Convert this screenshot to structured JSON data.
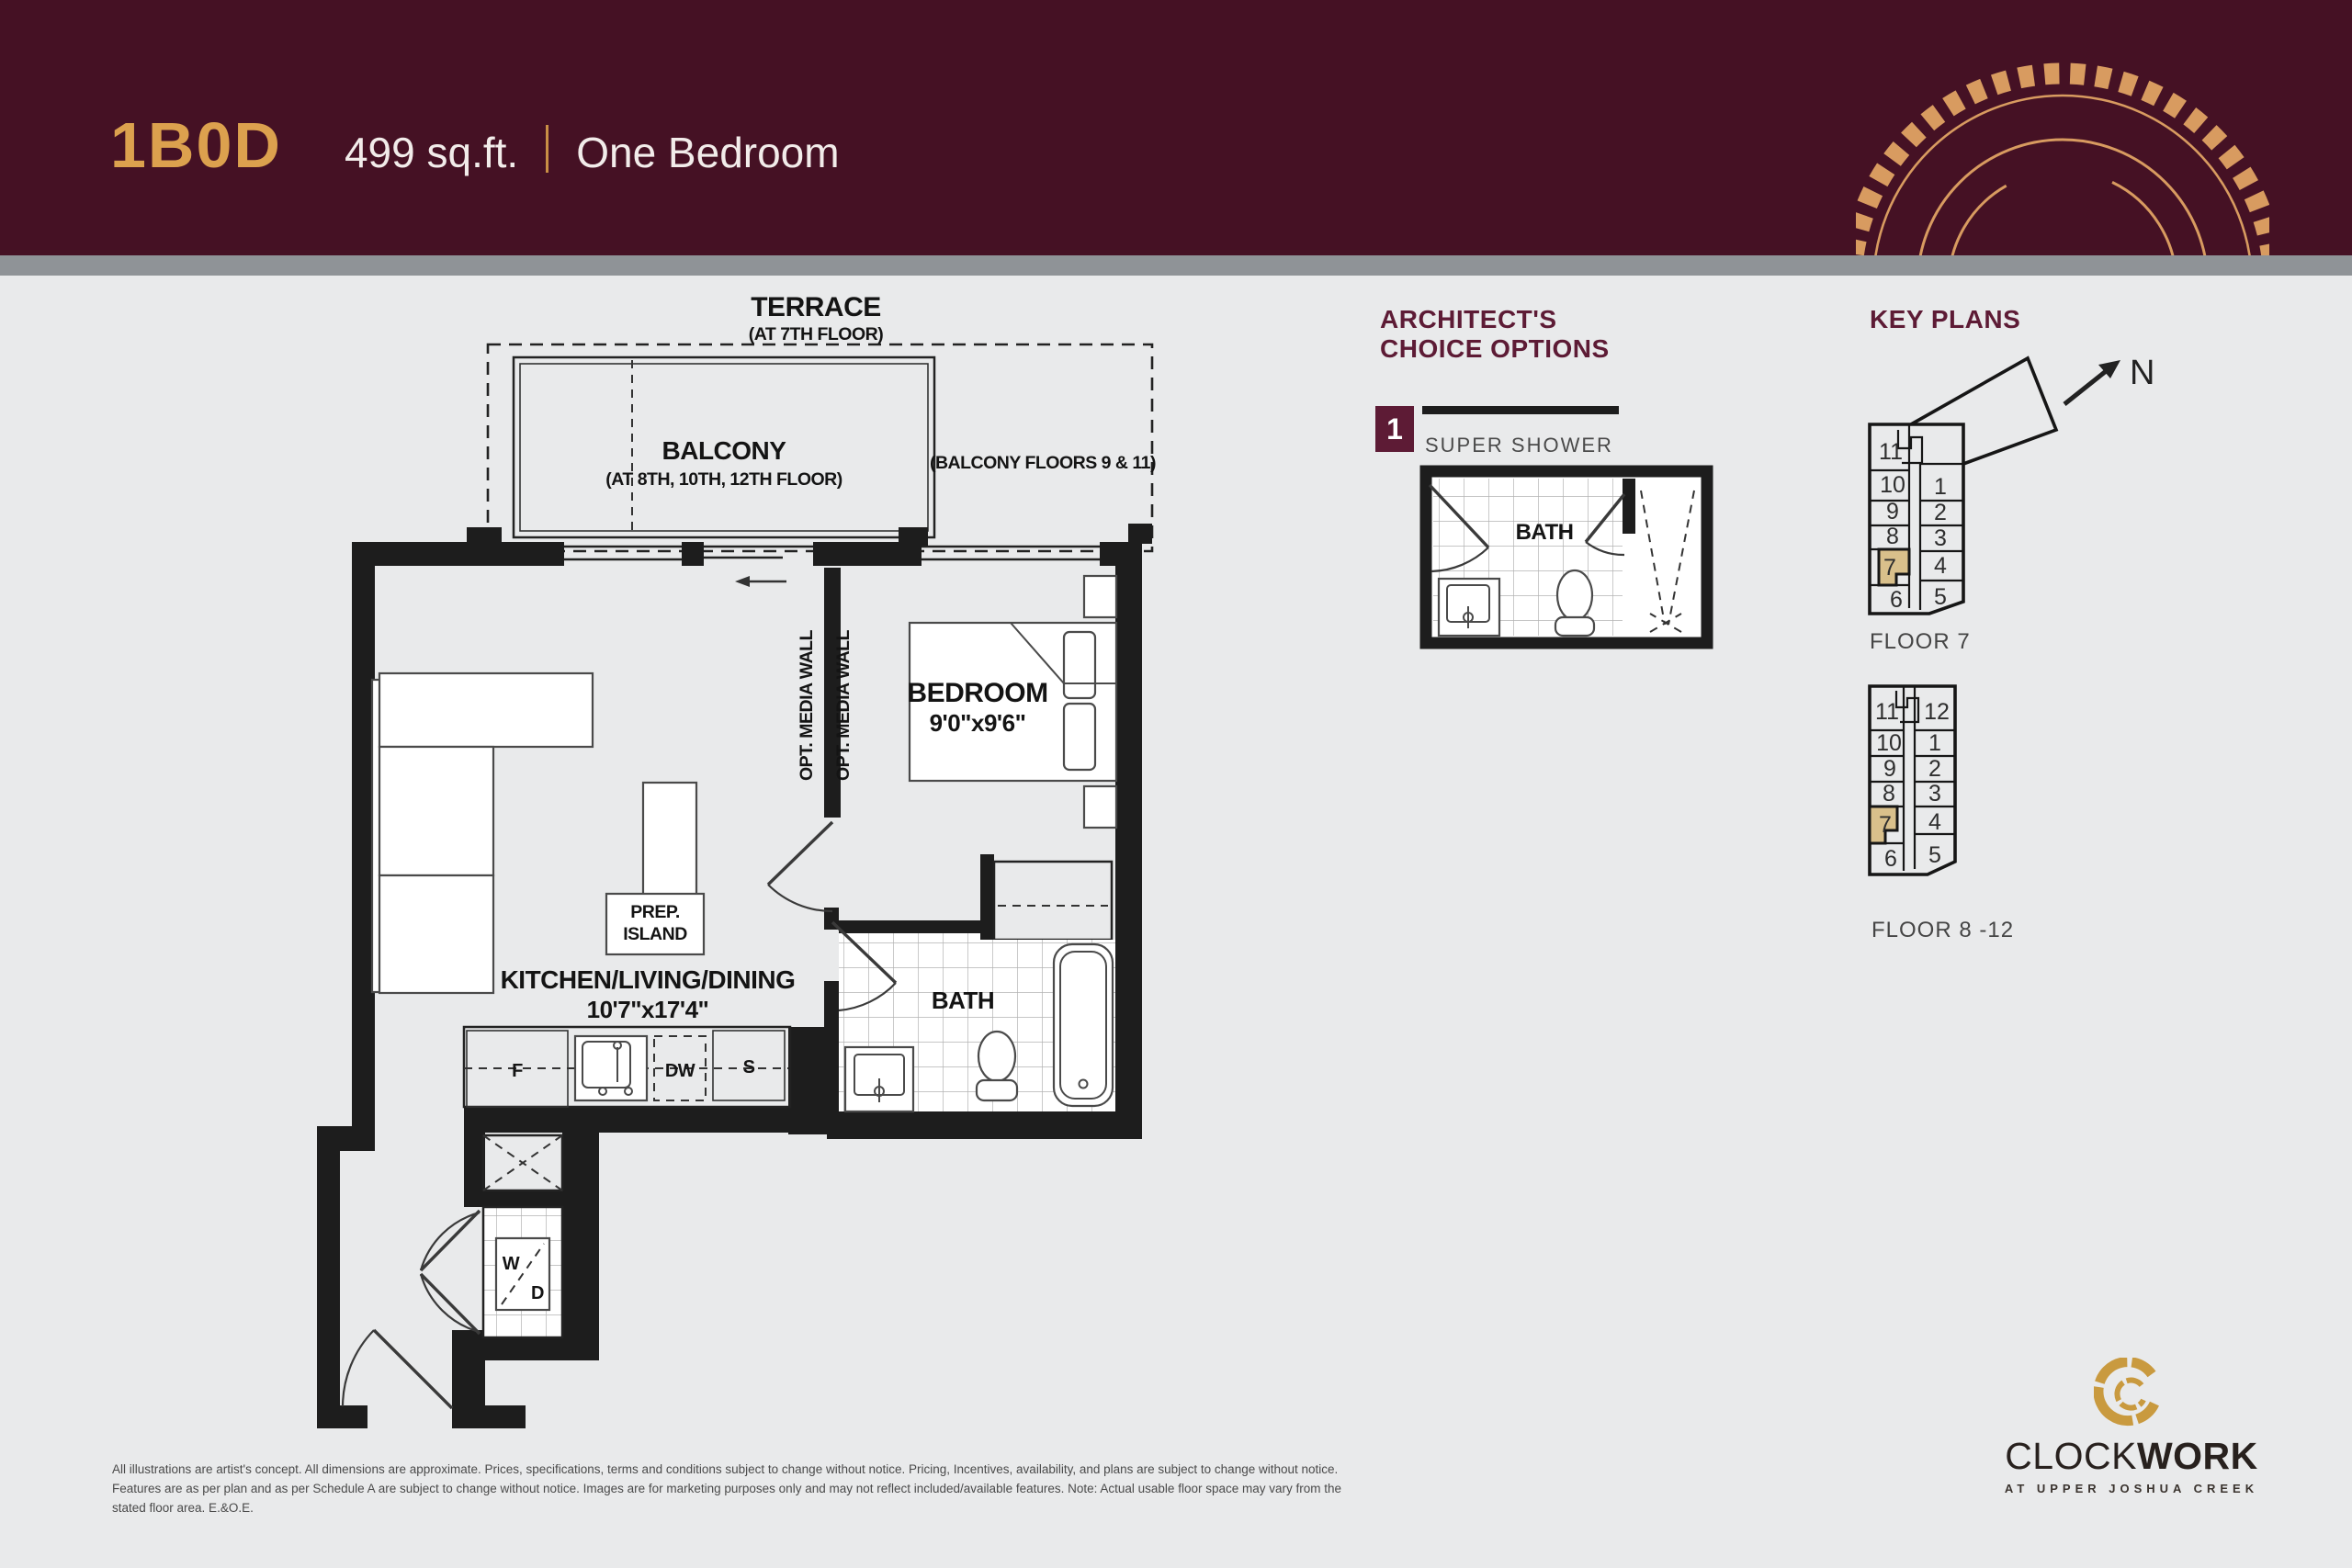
{
  "header": {
    "unit_code": "1B0D",
    "area": "499 sq.ft.",
    "type": "One Bedroom"
  },
  "plan": {
    "terrace": {
      "label": "TERRACE",
      "sub": "(AT 7TH FLOOR)"
    },
    "balcony": {
      "label": "BALCONY",
      "sub": "(AT 8TH, 10TH, 12TH FLOOR)",
      "alt": "(BALCONY FLOORS 9 & 11)"
    },
    "bedroom": {
      "label": "BEDROOM",
      "dims": "9'0\"x9'6\""
    },
    "living": {
      "label": "KITCHEN/LIVING/DINING",
      "dims": "10'7\"x17'4\""
    },
    "island": {
      "line1": "PREP.",
      "line2": "ISLAND"
    },
    "appliances": {
      "fridge": "F",
      "dishwasher": "DW",
      "counter": "S"
    },
    "laundry": {
      "washer": "W",
      "dryer": "D"
    },
    "bath": {
      "label": "BATH"
    },
    "media_wall": "OPT. MEDIA WALL"
  },
  "options": {
    "heading_line1": "ARCHITECT'S",
    "heading_line2": "CHOICE OPTIONS",
    "badge": "1",
    "item_label": "SUPER SHOWER",
    "bath_label": "BATH"
  },
  "key_plans": {
    "heading": "KEY PLANS",
    "north": "N",
    "floor7": {
      "caption": "FLOOR 7",
      "left_units": [
        "11",
        "10",
        "9",
        "8",
        "7",
        "6"
      ],
      "right_units": [
        "1",
        "2",
        "3",
        "4",
        "5"
      ]
    },
    "floor8_12": {
      "caption": "FLOOR 8 -12",
      "left_units": [
        "11",
        "10",
        "9",
        "8",
        "7",
        "6"
      ],
      "right_units": [
        "12",
        "1",
        "2",
        "3",
        "4",
        "5"
      ]
    }
  },
  "footer": {
    "disclaimer": "All illustrations are artist's concept. All dimensions are approximate. Prices, specifications, terms and conditions subject to change without notice. Pricing, Incentives, availability, and plans are subject to change without notice. Features are as per plan and as per Schedule A are subject to change without notice. Images are for marketing purposes only and may not reflect included/available features. Note: Actual usable floor space may vary from the stated floor area. E.&O.E.",
    "brand_left": "CLOCK",
    "brand_right": "WORK",
    "brand_sub": "AT UPPER JOSHUA CREEK"
  },
  "colors": {
    "header_bg": "#451124",
    "gold": "#DCA14E",
    "heading_maroon": "#5D1B35",
    "highlight_tan": "#D9C08B",
    "strip_gray": "#8F9397",
    "page_bg": "#E9EAEB",
    "wall_black": "#1D1D1D"
  }
}
